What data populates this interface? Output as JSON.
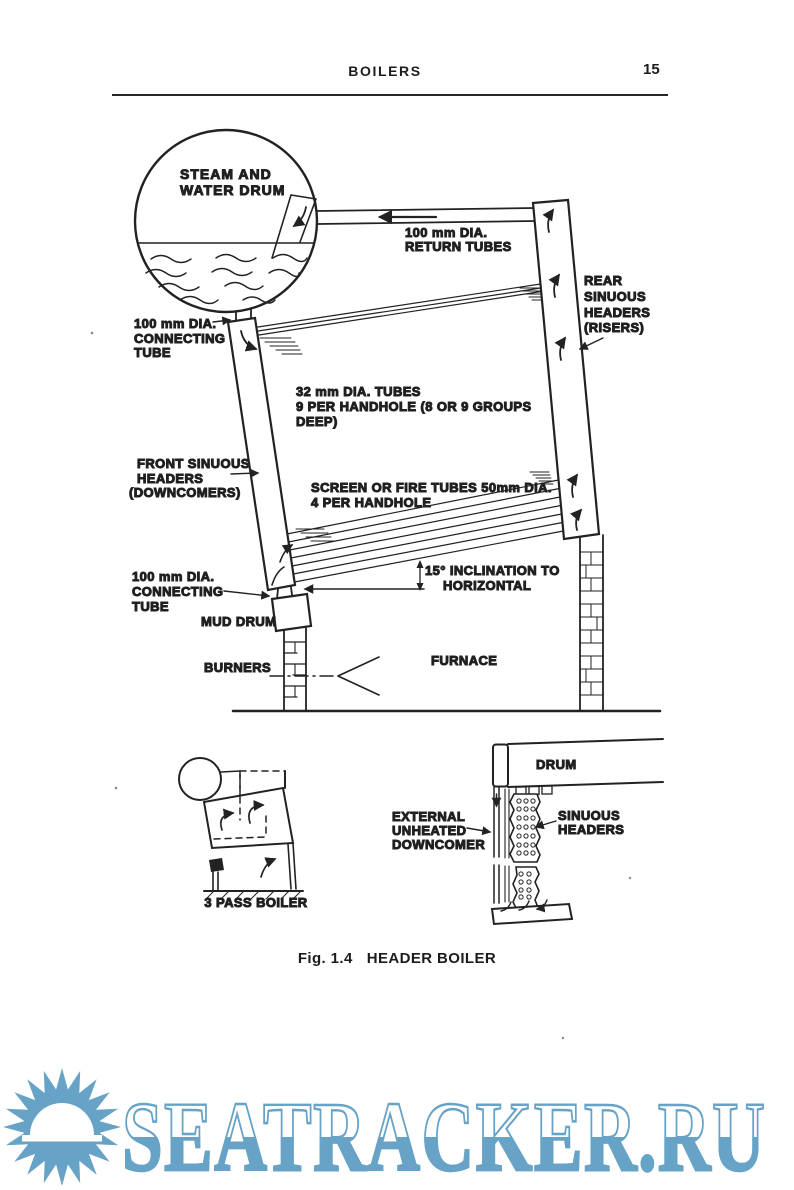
{
  "page": {
    "header_title": "BOILERS",
    "page_number": "15"
  },
  "caption": {
    "fig": "Fig. 1.4",
    "title": "HEADER BOILER"
  },
  "diagram": {
    "drum": [
      "STEAM AND",
      "WATER DRUM"
    ],
    "return_tubes": [
      "100 mm DIA.",
      "RETURN TUBES"
    ],
    "rear_header": [
      "REAR",
      "SINUOUS",
      "HEADERS",
      "(RISERS)"
    ],
    "connecting_tube_top": [
      "100 mm DIA.",
      "CONNECTING",
      "TUBE"
    ],
    "generating_tubes": [
      "32 mm  DIA. TUBES",
      "9 PER  HANDHOLE (8 OR 9 GROUPS",
      "DEEP)"
    ],
    "front_header": [
      "FRONT SINUOUS",
      "HEADERS",
      "(DOWNCOMERS)"
    ],
    "screen_tubes": [
      "SCREEN OR FIRE TUBES 50mm DIA.",
      "4 PER HANDHOLE"
    ],
    "inclination": [
      "15° INCLINATION TO",
      "HORIZONTAL"
    ],
    "connecting_tube_bottom": [
      "100 mm DIA.",
      "CONNECTING",
      "TUBE"
    ],
    "mud_drum": "MUD DRUM",
    "burners": "BURNERS",
    "furnace": "FURNACE"
  },
  "inset_left": {
    "caption": "3 PASS BOILER"
  },
  "inset_right": {
    "drum": "DRUM",
    "downcomer": [
      "EXTERNAL",
      "UNHEATED",
      "DOWNCOMER"
    ],
    "headers": [
      "SINUOUS",
      "HEADERS"
    ]
  },
  "watermark": {
    "site": "SEATRACKER.RU",
    "color": "#67a3c7",
    "icon": "sun-over-sea-icon"
  },
  "colors": {
    "ink": "#1f1f1f",
    "paper": "#ffffff"
  }
}
